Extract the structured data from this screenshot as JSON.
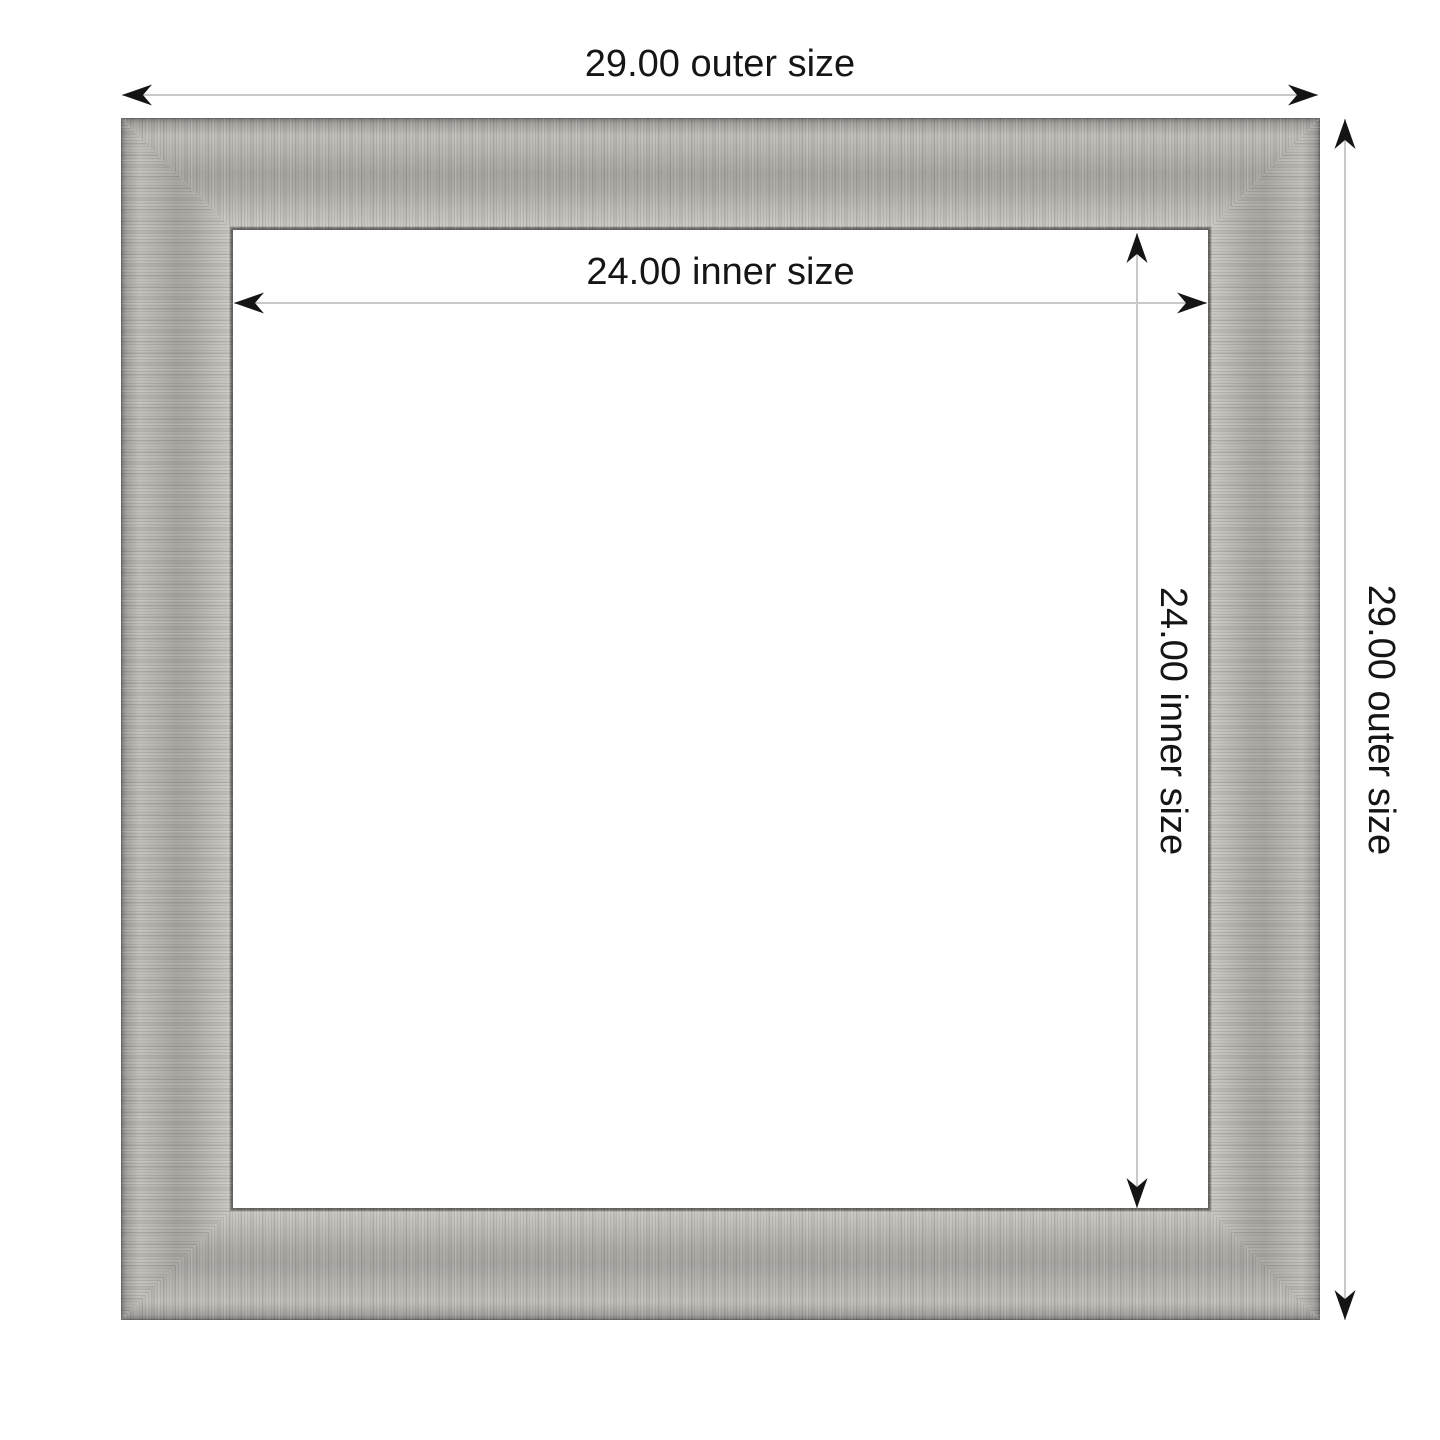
{
  "page": {
    "background": "#ffffff",
    "type": "picture-frame dimension diagram"
  },
  "frame": {
    "finish": "brushed silver",
    "colors": {
      "metal_light": "#c7c4c0",
      "metal_mid": "#aeaba7",
      "metal_edge_dark": "#605e5a"
    }
  },
  "dimensions": {
    "outer_width": {
      "value": "29.00",
      "label": "29.00 outer size"
    },
    "outer_height": {
      "value": "29.00",
      "label": "29.00 outer size"
    },
    "inner_width": {
      "value": "24.00",
      "label": "24.00 inner size"
    },
    "inner_height": {
      "value": "24.00",
      "label": "24.00 inner size"
    }
  },
  "style": {
    "dimension_line_color": "#c9c9c9",
    "arrow_color": "#141414",
    "text_color": "#151515"
  }
}
